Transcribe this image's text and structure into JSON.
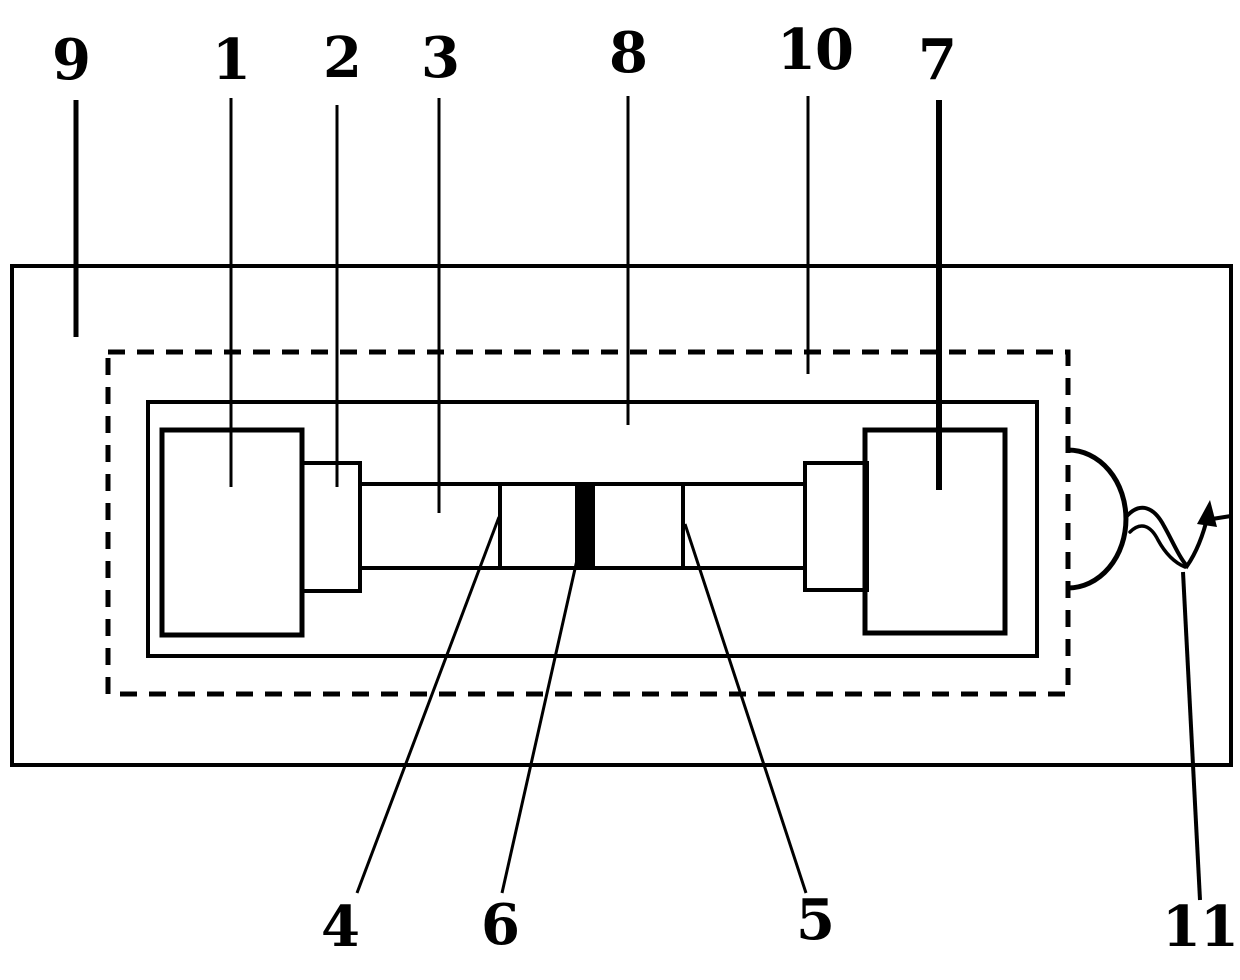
{
  "figure": {
    "kind": "patent-line-drawing",
    "colors": {
      "ink": "#000000",
      "paper": "#ffffff"
    },
    "callouts": {
      "c1": "1",
      "c2": "2",
      "c3": "3",
      "c4": "4",
      "c5": "5",
      "c6": "6",
      "c7": "7",
      "c8": "8",
      "c9": "9",
      "c10": "10",
      "c11": "11"
    }
  }
}
